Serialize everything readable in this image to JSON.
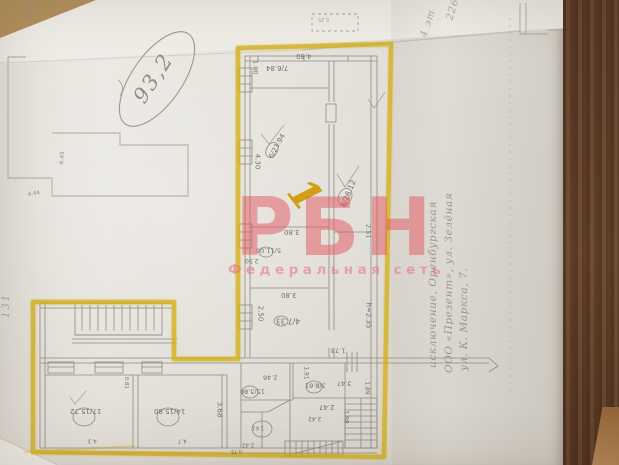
{
  "watermark": {
    "logo": "РБН",
    "tagline": "Федеральная сеть",
    "logo_color": "#e4575f"
  },
  "handwritten": {
    "area_note": "93,2",
    "premises_mark": "1",
    "margin_note_left": "131",
    "top_note_1": "4 эт",
    "top_note_2": "226",
    "side_notes": [
      {
        "text": "исключение, Оренбургская",
        "x": 427,
        "y": 368
      },
      {
        "text": "ООО «Презент», ул. Зелёная",
        "x": 443,
        "y": 373
      },
      {
        "text": "ул. К. Маркса, 7.",
        "x": 458,
        "y": 371
      }
    ]
  },
  "plan": {
    "height_note": "h=2.35",
    "labels": [
      {
        "t": "4.80",
        "x": 296,
        "y": 52,
        "r": 180,
        "s": 7,
        "c": "ink"
      },
      {
        "t": "1.80",
        "x": 248,
        "y": 64,
        "r": 90,
        "s": 6.5,
        "c": "ink"
      },
      {
        "t": "7/6.84",
        "x": 266,
        "y": 64,
        "r": 180,
        "s": 7,
        "c": "ink"
      },
      {
        "t": "4.30",
        "x": 249,
        "y": 158,
        "r": 90,
        "s": 7,
        "c": "ink"
      },
      {
        "t": "6/23.94",
        "x": 264,
        "y": 143,
        "r": -62,
        "s": 7,
        "c": "ink"
      },
      {
        "t": "8/26.12",
        "x": 334,
        "y": 190,
        "r": -68,
        "s": 7.5,
        "c": "ink"
      },
      {
        "t": "3.80",
        "x": 284,
        "y": 228,
        "r": 180,
        "s": 7,
        "c": "ink"
      },
      {
        "t": "5/11.06",
        "x": 256,
        "y": 247,
        "r": 180,
        "s": 6.5,
        "c": "ink"
      },
      {
        "t": "2.50",
        "x": 245,
        "y": 257,
        "r": 180,
        "s": 6,
        "c": "ink"
      },
      {
        "t": "3.80",
        "x": 281,
        "y": 291,
        "r": 180,
        "s": 7,
        "c": "ink"
      },
      {
        "t": "2.50",
        "x": 252,
        "y": 310,
        "r": 90,
        "s": 7,
        "c": "ink"
      },
      {
        "t": "4/7.33",
        "x": 276,
        "y": 317,
        "r": 180,
        "s": 7.5,
        "c": "ink"
      },
      {
        "t": "h=2.35",
        "x": 355,
        "y": 312,
        "r": 90,
        "s": 7,
        "c": "ink"
      },
      {
        "t": "2.51",
        "x": 361,
        "y": 228,
        "r": 90,
        "s": 6.5,
        "c": "ink"
      },
      {
        "t": "1.73",
        "x": 331,
        "y": 347,
        "r": 180,
        "s": 6.5,
        "c": "ink"
      },
      {
        "t": "3.47",
        "x": 337,
        "y": 380,
        "r": 180,
        "s": 6.5,
        "c": "ink"
      },
      {
        "t": "1.89",
        "x": 360,
        "y": 385,
        "r": 90,
        "s": 6,
        "c": "ink"
      },
      {
        "t": "2.46",
        "x": 263,
        "y": 374,
        "r": 180,
        "s": 6.5,
        "c": "ink"
      },
      {
        "t": "15/3.86",
        "x": 240,
        "y": 388,
        "r": 180,
        "s": 6.5,
        "c": "ink"
      },
      {
        "t": "3/8.61",
        "x": 305,
        "y": 382,
        "r": 180,
        "s": 6.5,
        "c": "ink"
      },
      {
        "t": "2.47",
        "x": 319,
        "y": 403,
        "r": 180,
        "s": 7,
        "c": "ink"
      },
      {
        "t": "1.91",
        "x": 299,
        "y": 370,
        "r": 90,
        "s": 6,
        "c": "ink"
      },
      {
        "t": "2.42",
        "x": 308,
        "y": 415,
        "r": 180,
        "s": 6,
        "c": "ink"
      },
      {
        "t": "1.98",
        "x": 339,
        "y": 414,
        "r": 90,
        "s": 6,
        "c": "ink"
      },
      {
        "t": "1.61",
        "x": 252,
        "y": 424,
        "r": 180,
        "s": 5.5,
        "c": "ink"
      },
      {
        "t": "2.42",
        "x": 242,
        "y": 441,
        "r": 180,
        "s": 5.5,
        "c": "ink"
      },
      {
        "t": "0.75",
        "x": 231,
        "y": 448,
        "r": 180,
        "s": 5,
        "c": "ink"
      },
      {
        "t": "0.81",
        "x": 119,
        "y": 380,
        "r": 90,
        "s": 5.5,
        "c": "ink"
      },
      {
        "t": "3.68",
        "x": 211,
        "y": 406,
        "r": 90,
        "s": 7,
        "c": "ink"
      },
      {
        "t": "17/15.72",
        "x": 70,
        "y": 407,
        "r": 180,
        "s": 7,
        "c": "ink"
      },
      {
        "t": "14/15.80",
        "x": 154,
        "y": 407,
        "r": 180,
        "s": 7,
        "c": "ink"
      },
      {
        "t": "4.3",
        "x": 88,
        "y": 437,
        "r": 180,
        "s": 5.5,
        "c": "ink"
      },
      {
        "t": "4.7",
        "x": 178,
        "y": 437,
        "r": 180,
        "s": 5.5,
        "c": "ink"
      },
      {
        "t": "150",
        "x": 24,
        "y": 8,
        "r": -70,
        "s": 8,
        "c": "pencil"
      },
      {
        "t": "4.45",
        "x": 56,
        "y": 155,
        "r": -85,
        "s": 6,
        "c": "pencil"
      },
      {
        "t": "4.44",
        "x": 28,
        "y": 192,
        "r": -10,
        "s": 5.5,
        "c": "pencil"
      },
      {
        "t": "5.25",
        "x": 318,
        "y": 16,
        "r": 180,
        "s": 5,
        "c": "faint"
      }
    ]
  },
  "colors": {
    "highlighter": "#d4b11c",
    "watermark": "#e4575f",
    "paper": "#e8e5df",
    "wood": "#5e3c26"
  }
}
